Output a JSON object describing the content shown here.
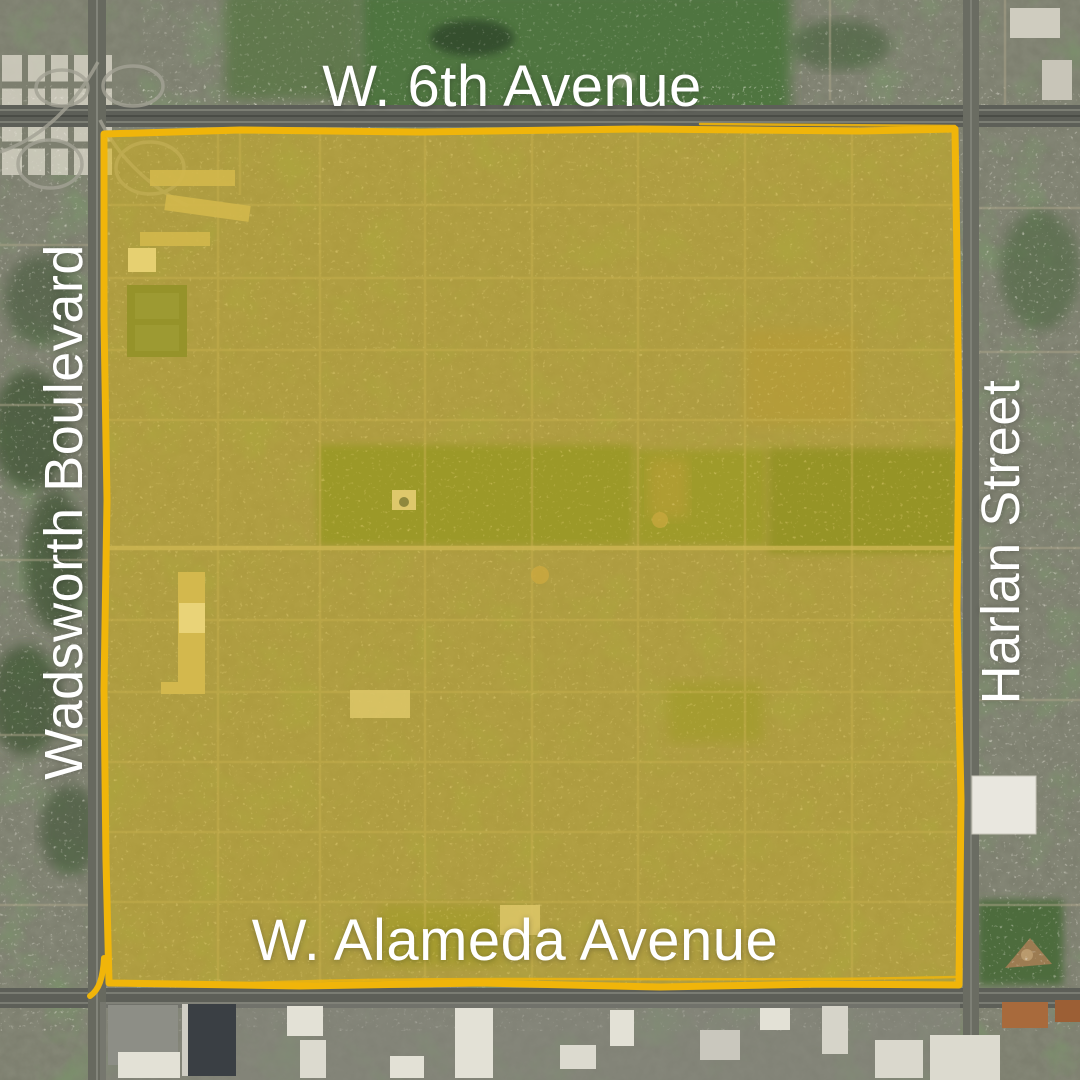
{
  "map": {
    "kind": "satellite-highlight-graphic",
    "labels": {
      "top": "W. 6th Avenue",
      "left": "Wadsworth Boulevard",
      "right": "Harlan Street",
      "bottom": "W. Alameda Avenue"
    },
    "label_color": "#FFFFFF",
    "highlight": {
      "border_color": "#F0B50A",
      "fill_color": "#DDB70F"
    }
  }
}
